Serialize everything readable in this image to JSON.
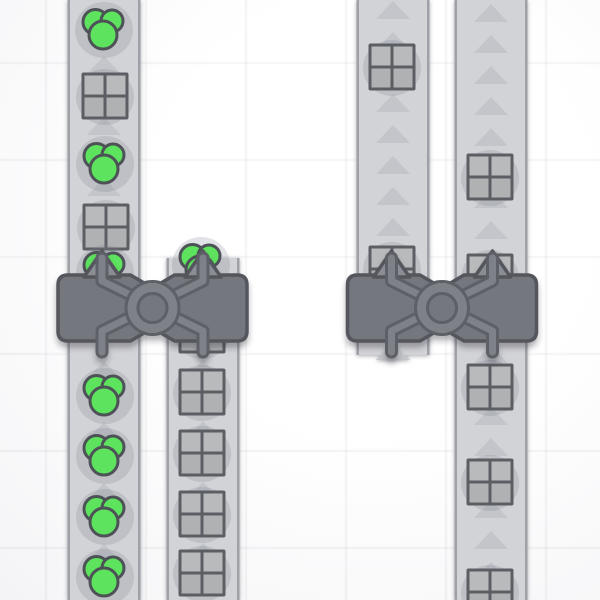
{
  "scene": {
    "title": "factory-conveyor-viewport",
    "width": 600,
    "height": 600
  },
  "palette": {
    "bg_center": "#ffffff",
    "bg_edge": "#e9e9ec",
    "grid_line": "rgba(70,76,94,0.05)",
    "belt_fill": "#d2d3d7",
    "belt_border": "#9fa1a7",
    "belt_arrow": "#c3c5ca",
    "belt_shadow": "rgba(100,104,114,0.55)",
    "item_halo": "rgba(125,128,140,0.22)",
    "shape_green": "#5ee35e",
    "shape_green_outline": "#4d5257",
    "crate_cell_top": "#b9babc",
    "crate_cell_bottom": "#b0b1b3",
    "crate_outline": "#5b5e63",
    "machine_body": "#74777e",
    "machine_outline": "#54575d",
    "tube_light": "#7e8188",
    "tube_dark": "#5d6066",
    "arrow_fill": "#8a8d94",
    "machine_shadow": "rgba(40,44,52,0.35)"
  },
  "grid": {
    "vlines": [
      46,
      146,
      246,
      346,
      446,
      546
    ],
    "hlines": [
      63,
      160,
      257,
      354,
      451,
      548
    ],
    "line_width": 2.5
  },
  "belts": [
    {
      "id": "belt-a",
      "cx": 104,
      "top": 0,
      "bottom": 600,
      "width": 73,
      "arrow_spacing": 61,
      "arrow_phase": 4,
      "direction": "up"
    },
    {
      "id": "belt-b",
      "cx": 203,
      "top": 258,
      "bottom": 600,
      "width": 73,
      "arrow_spacing": 61,
      "arrow_phase": 3,
      "direction": "up"
    },
    {
      "id": "belt-c",
      "cx": 393,
      "top": 0,
      "bottom": 355,
      "width": 73,
      "arrow_spacing": 31,
      "arrow_phase": 10,
      "direction": "up"
    },
    {
      "id": "belt-d",
      "cx": 491,
      "top": 0,
      "bottom": 600,
      "width": 73,
      "arrow_spacing": 31,
      "arrow_phase": 13,
      "direction": "up"
    }
  ],
  "items": [
    {
      "type": "green-cluster",
      "x": 104,
      "y": 29
    },
    {
      "type": "crate",
      "x": 105,
      "y": 96
    },
    {
      "type": "green-cluster",
      "x": 105,
      "y": 163
    },
    {
      "type": "crate",
      "x": 106,
      "y": 227
    },
    {
      "type": "green-cluster",
      "x": 105,
      "y": 272
    },
    {
      "type": "green-cluster",
      "x": 105,
      "y": 395
    },
    {
      "type": "green-cluster",
      "x": 105,
      "y": 455
    },
    {
      "type": "green-cluster",
      "x": 105,
      "y": 516
    },
    {
      "type": "green-cluster",
      "x": 105,
      "y": 576
    },
    {
      "type": "green-cluster",
      "x": 201,
      "y": 264
    },
    {
      "type": "crate",
      "x": 202,
      "y": 330
    },
    {
      "type": "crate",
      "x": 202,
      "y": 392
    },
    {
      "type": "crate",
      "x": 202,
      "y": 453
    },
    {
      "type": "crate",
      "x": 202,
      "y": 514
    },
    {
      "type": "crate",
      "x": 202,
      "y": 573
    },
    {
      "type": "crate",
      "x": 392,
      "y": 67
    },
    {
      "type": "crate",
      "x": 392,
      "y": 269
    },
    {
      "type": "crate",
      "x": 490,
      "y": 177
    },
    {
      "type": "crate",
      "x": 490,
      "y": 277
    },
    {
      "type": "crate",
      "x": 490,
      "y": 387
    },
    {
      "type": "crate",
      "x": 490,
      "y": 482
    },
    {
      "type": "crate",
      "x": 490,
      "y": 592
    }
  ],
  "machines": [
    {
      "id": "balancer-1",
      "cx": 152.5,
      "input_offset": 50.5
    },
    {
      "id": "balancer-2",
      "cx": 442,
      "input_offset": 50.5
    }
  ],
  "machine_style": {
    "half_width": 94.5,
    "body_top": 275,
    "body_bottom": 341,
    "corner_radius": 10,
    "notch_half": 22,
    "notch_depth": 13,
    "arrow_tip_y": 251,
    "arrow_base_y": 277,
    "arrow_half": 18,
    "tube_top": 258,
    "tube_elbow_top": 281,
    "tube_elbow_bottom": 331,
    "tube_bottom": 352,
    "tube_outer_w": 13,
    "tube_inner_w": 7,
    "ring_outer_r": 26.5,
    "ring_inner_r": 14.5
  },
  "item_style": {
    "crate_size": 47,
    "cluster_circles": [
      {
        "dx": -8.5,
        "dy": -7,
        "r": 12.5
      },
      {
        "dx": 8,
        "dy": -8,
        "r": 11
      },
      {
        "dx": -1,
        "dy": 6,
        "r": 14
      }
    ],
    "halo_r": 29
  }
}
